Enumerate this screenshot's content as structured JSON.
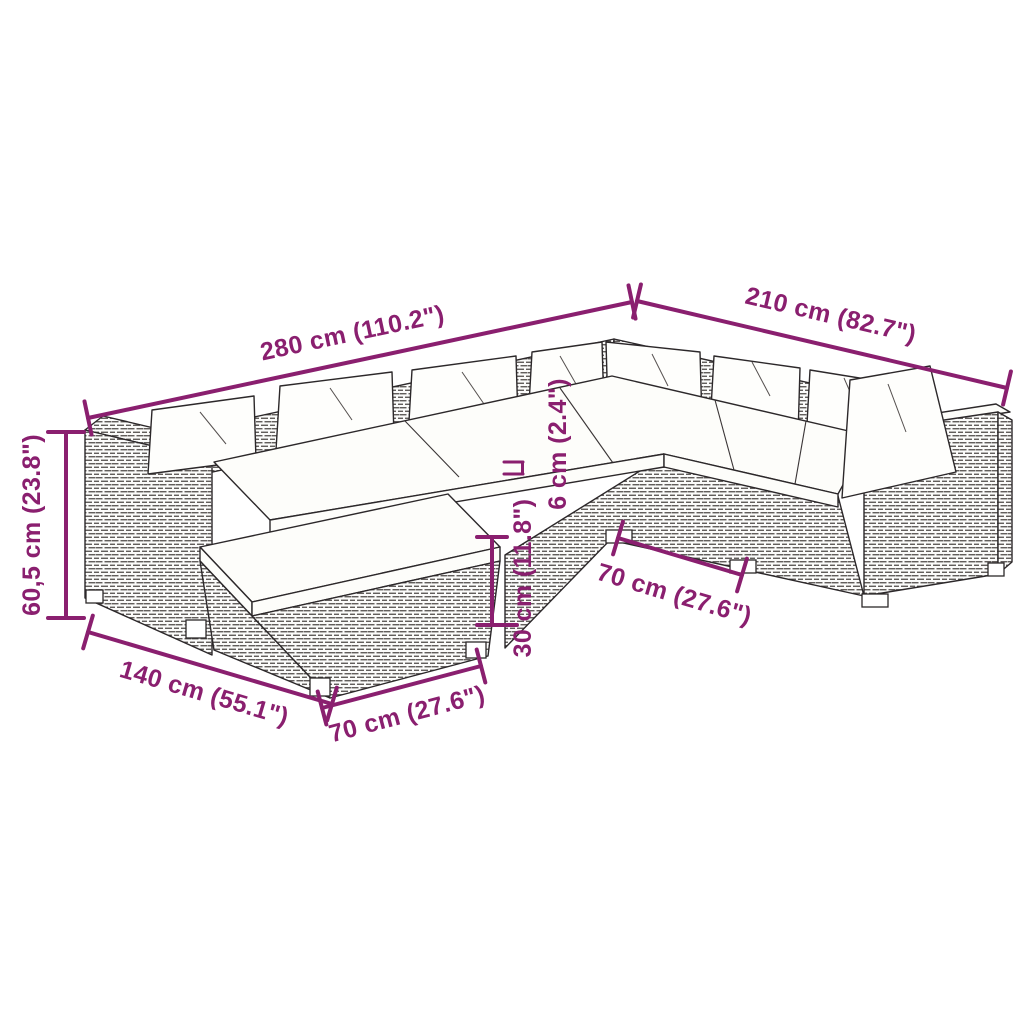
{
  "annotations": {
    "width_total": "280 cm (110.2\")",
    "depth_total": "210 cm (82.7\")",
    "height_total": "60,5 cm (23.8\")",
    "depth_left_section": "140 cm (55.1\")",
    "footstool_width": "70 cm (27.6\")",
    "seat_height": "30 cm (11.8\")",
    "cushion_thickness": "6 cm (2.4\")",
    "module_width": "70 cm (27.6\")"
  },
  "colors": {
    "dimension_annotation": "#8a1f6f",
    "linework": "#2c282a",
    "cushion_fill": "#fdfdfa"
  }
}
